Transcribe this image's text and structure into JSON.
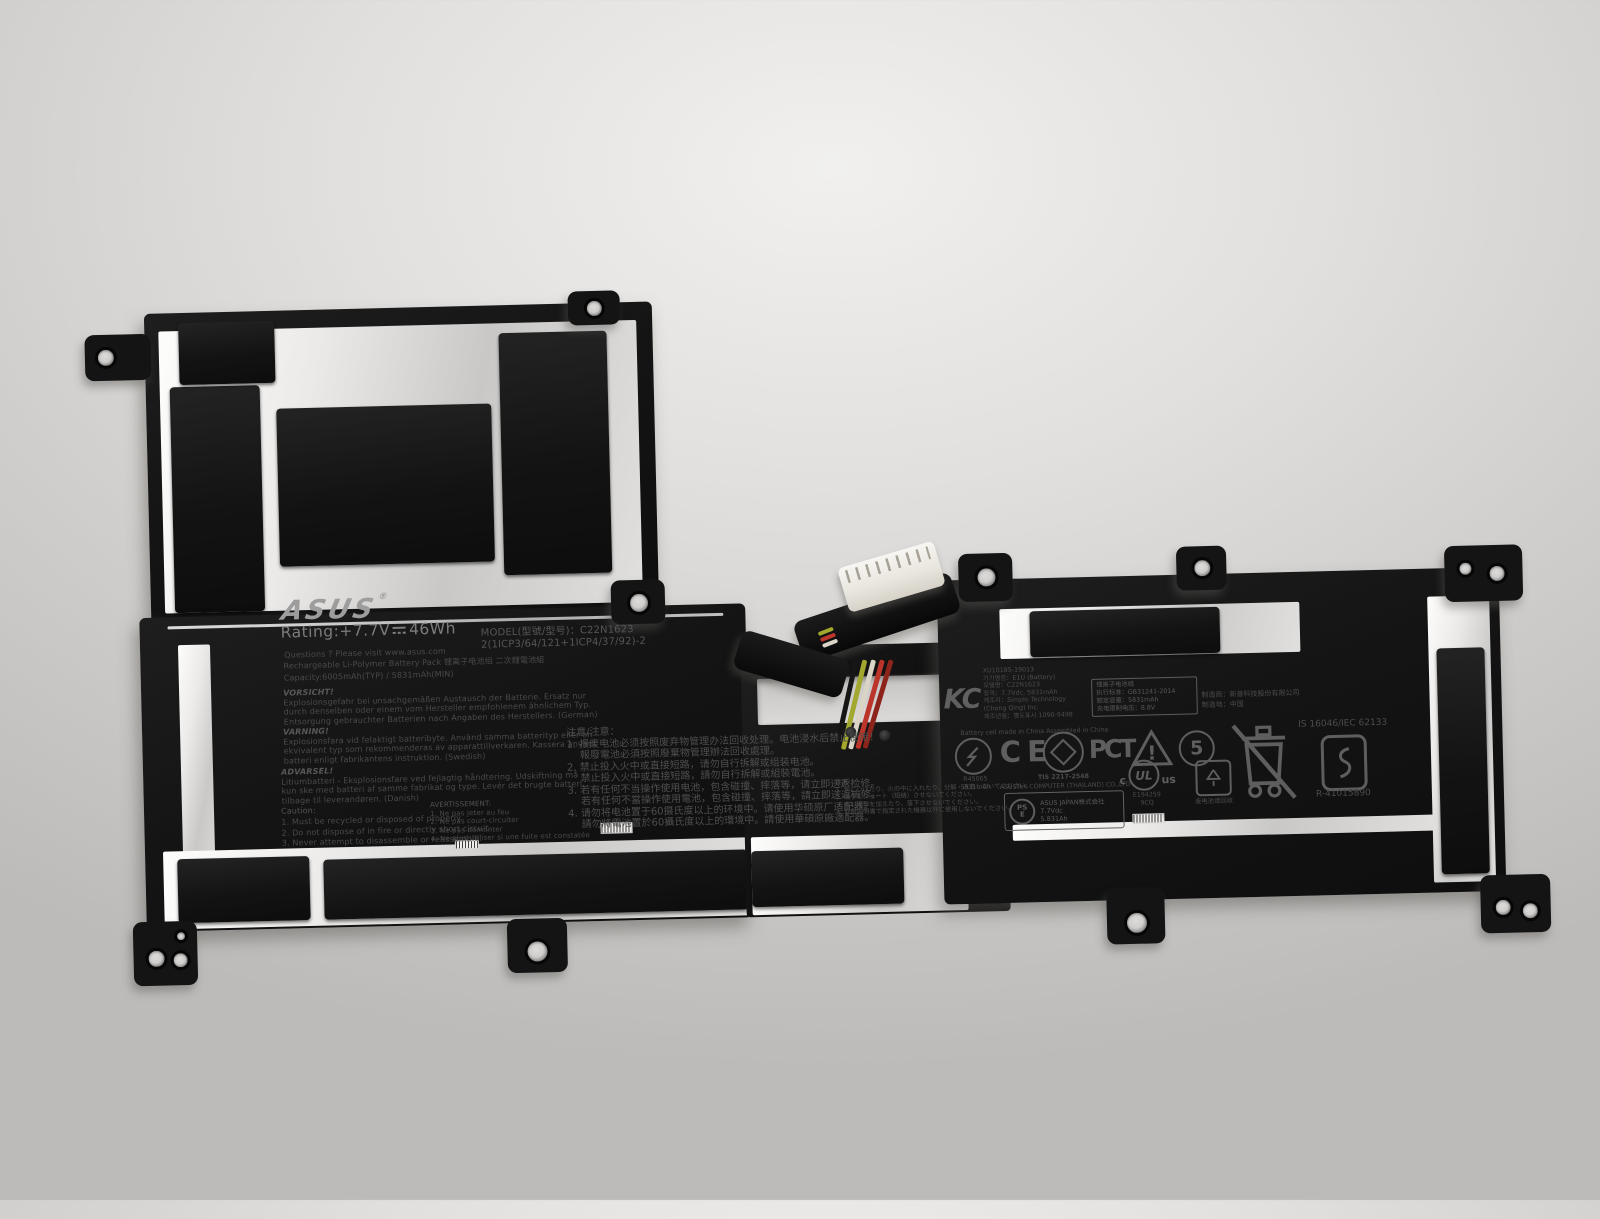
{
  "photo": {
    "subject": "ASUS C22N1623 laptop battery on gray surface",
    "brand": {
      "logo": "ASUS",
      "reg": "®"
    },
    "rating": {
      "prefix": "Rating:+7.7V",
      "suffix": "46Wh"
    },
    "left_label": {
      "questions": "Questions ? Please visit www.asus.com",
      "pack_type": "Rechargeable Li-Polymer Battery Pack  锂离子电池组  二次鋰電池組",
      "capacity": "Capacity:6005mAh(TYP) / 5831mAh(MIN)",
      "model_line1": "MODEL(型號/型号)：C22N1623",
      "model_line2": "2(1ICP3/64/121+1ICP4/37/92)-2",
      "warn_de": {
        "title": "VORSICHT!",
        "lines": [
          "Explosionsgefahr bei unsachgemäßen Austausch der Batterie. Ersatz nur",
          "durch denselben oder einem vom Hersteller empfohlenem ähnlichem Typ.",
          "Entsorgung gebrauchter Batterien nach Angaben des Herstellers. (German)"
        ]
      },
      "warn_sv": {
        "title": "VARNING!",
        "lines": [
          "Explosionsfara vid felaktigt batteribyte. Använd samma batterityp eller en",
          "ekvivalent typ som rekommenderas av apparattillverkaren. Kassera använt",
          "batteri enligt fabrikantens instruktion. (Swedish)"
        ]
      },
      "warn_da": {
        "title": "ADVARSEL!",
        "lines": [
          "Litiumbatteri - Eksplosionsfare ved fejlagtig håndtering. Udskiftning må",
          "kun ske med batteri af samme fabrikat og type. Levér det brugte batteri",
          "tilbage til leverandøren. (Danish)"
        ]
      },
      "caution_en": {
        "title": "Caution:",
        "lines": [
          "1. Must be recycled or disposed of properly.",
          "2. Do not dispose of in fire or directly short circuit.",
          "3. Never attempt to disassemble or reassemble."
        ]
      },
      "caution_fr": {
        "title": "AVERTISSEMENT:",
        "lines": [
          "1. Ne pas jeter au feu",
          "2. Ne pas court-circuiter",
          "3. Ne pas démonter",
          "4. Ne plus utiliser si une fuite est constatée"
        ]
      }
    },
    "notice_cn": {
      "title": "注意/注意：",
      "lines": [
        "1. 报废电池必须按照废弃物管理办法回收处理。电池浸水后禁止使用！",
        "　 報廢電池必須按照廢棄物管理辦法回收處理。",
        "2. 禁止投入火中或直接短路，请勿自行拆解或组装电池。",
        "　 禁止投入火中或直接短路，請勿自行拆解或組裝電池。",
        "3. 若有任何不当操作使用电池，包含碰撞、摔落等，请立即送返检修。",
        "　 若有任何不當操作使用電池，包含碰撞、摔落等，請立即送返檢修。",
        "4. 请勿将电池置于60摄氏度以上的环境中。请使用华硕原厂适配器。",
        "　 請勿將電池置於60攝氏度以上的環境中。請使用華碩原廠適配器。"
      ]
    },
    "notice_jp": {
      "title": "注意：",
      "lines": [
        "1. 水につけたり、火の中に入れたり、分解・改造しないでください。",
        "2. 端子をショート（短絡）させないでください。",
        "3. 強い衝撃を加えたり、落下させないでください。",
        "4. 取扱説明書で指定された機器以外に使用しないでください。"
      ]
    },
    "kc": {
      "mark": "KC",
      "cert_no": "XU10185-19013",
      "lines": [
        "기기명칭：E1U (Battery)",
        "모델명：C22N1623",
        "정격：7.7Vdc, 5831mAh",
        "제조자：Simplo Technology",
        "(Chong Qing) Inc.",
        "제조년월：별도표시  1090-9498"
      ],
      "footer": "Battery cell made in China Assembled in China"
    },
    "spec_box": {
      "lines": [
        "锂离子电池组",
        "执行标准：GB31241-2014",
        "额定容量：5831mAh",
        "充电限制电压：8.8V"
      ]
    },
    "maker": {
      "line1": "制造商：新普科技股份有限公司",
      "line2": "制造地：中国"
    },
    "certs": {
      "bsmi": {
        "reg": "R45065",
        "cap": "5831mAh"
      },
      "ce": "CE",
      "tis": {
        "no": "TIS 2217-2548",
        "company": "ASUSTeK COMPUTER (THAILAND) CO.,LTD"
      },
      "gost": "PCТ",
      "warning_mark": "!",
      "efup": "5",
      "ul": {
        "c": "c",
        "label": "UL",
        "us": "us",
        "file": "E194259",
        "code": "9CQ"
      },
      "battery_recycle_text": "废电池请回收",
      "bis": {
        "standard": "IS 16046/IEC 62133",
        "reg": "R-41015890"
      },
      "pse": {
        "ps": "PS",
        "e": "E",
        "company": "ASUS JAPAN株式会社",
        "volts": "7.7Vdc",
        "amph": "5.831Ah"
      }
    }
  }
}
